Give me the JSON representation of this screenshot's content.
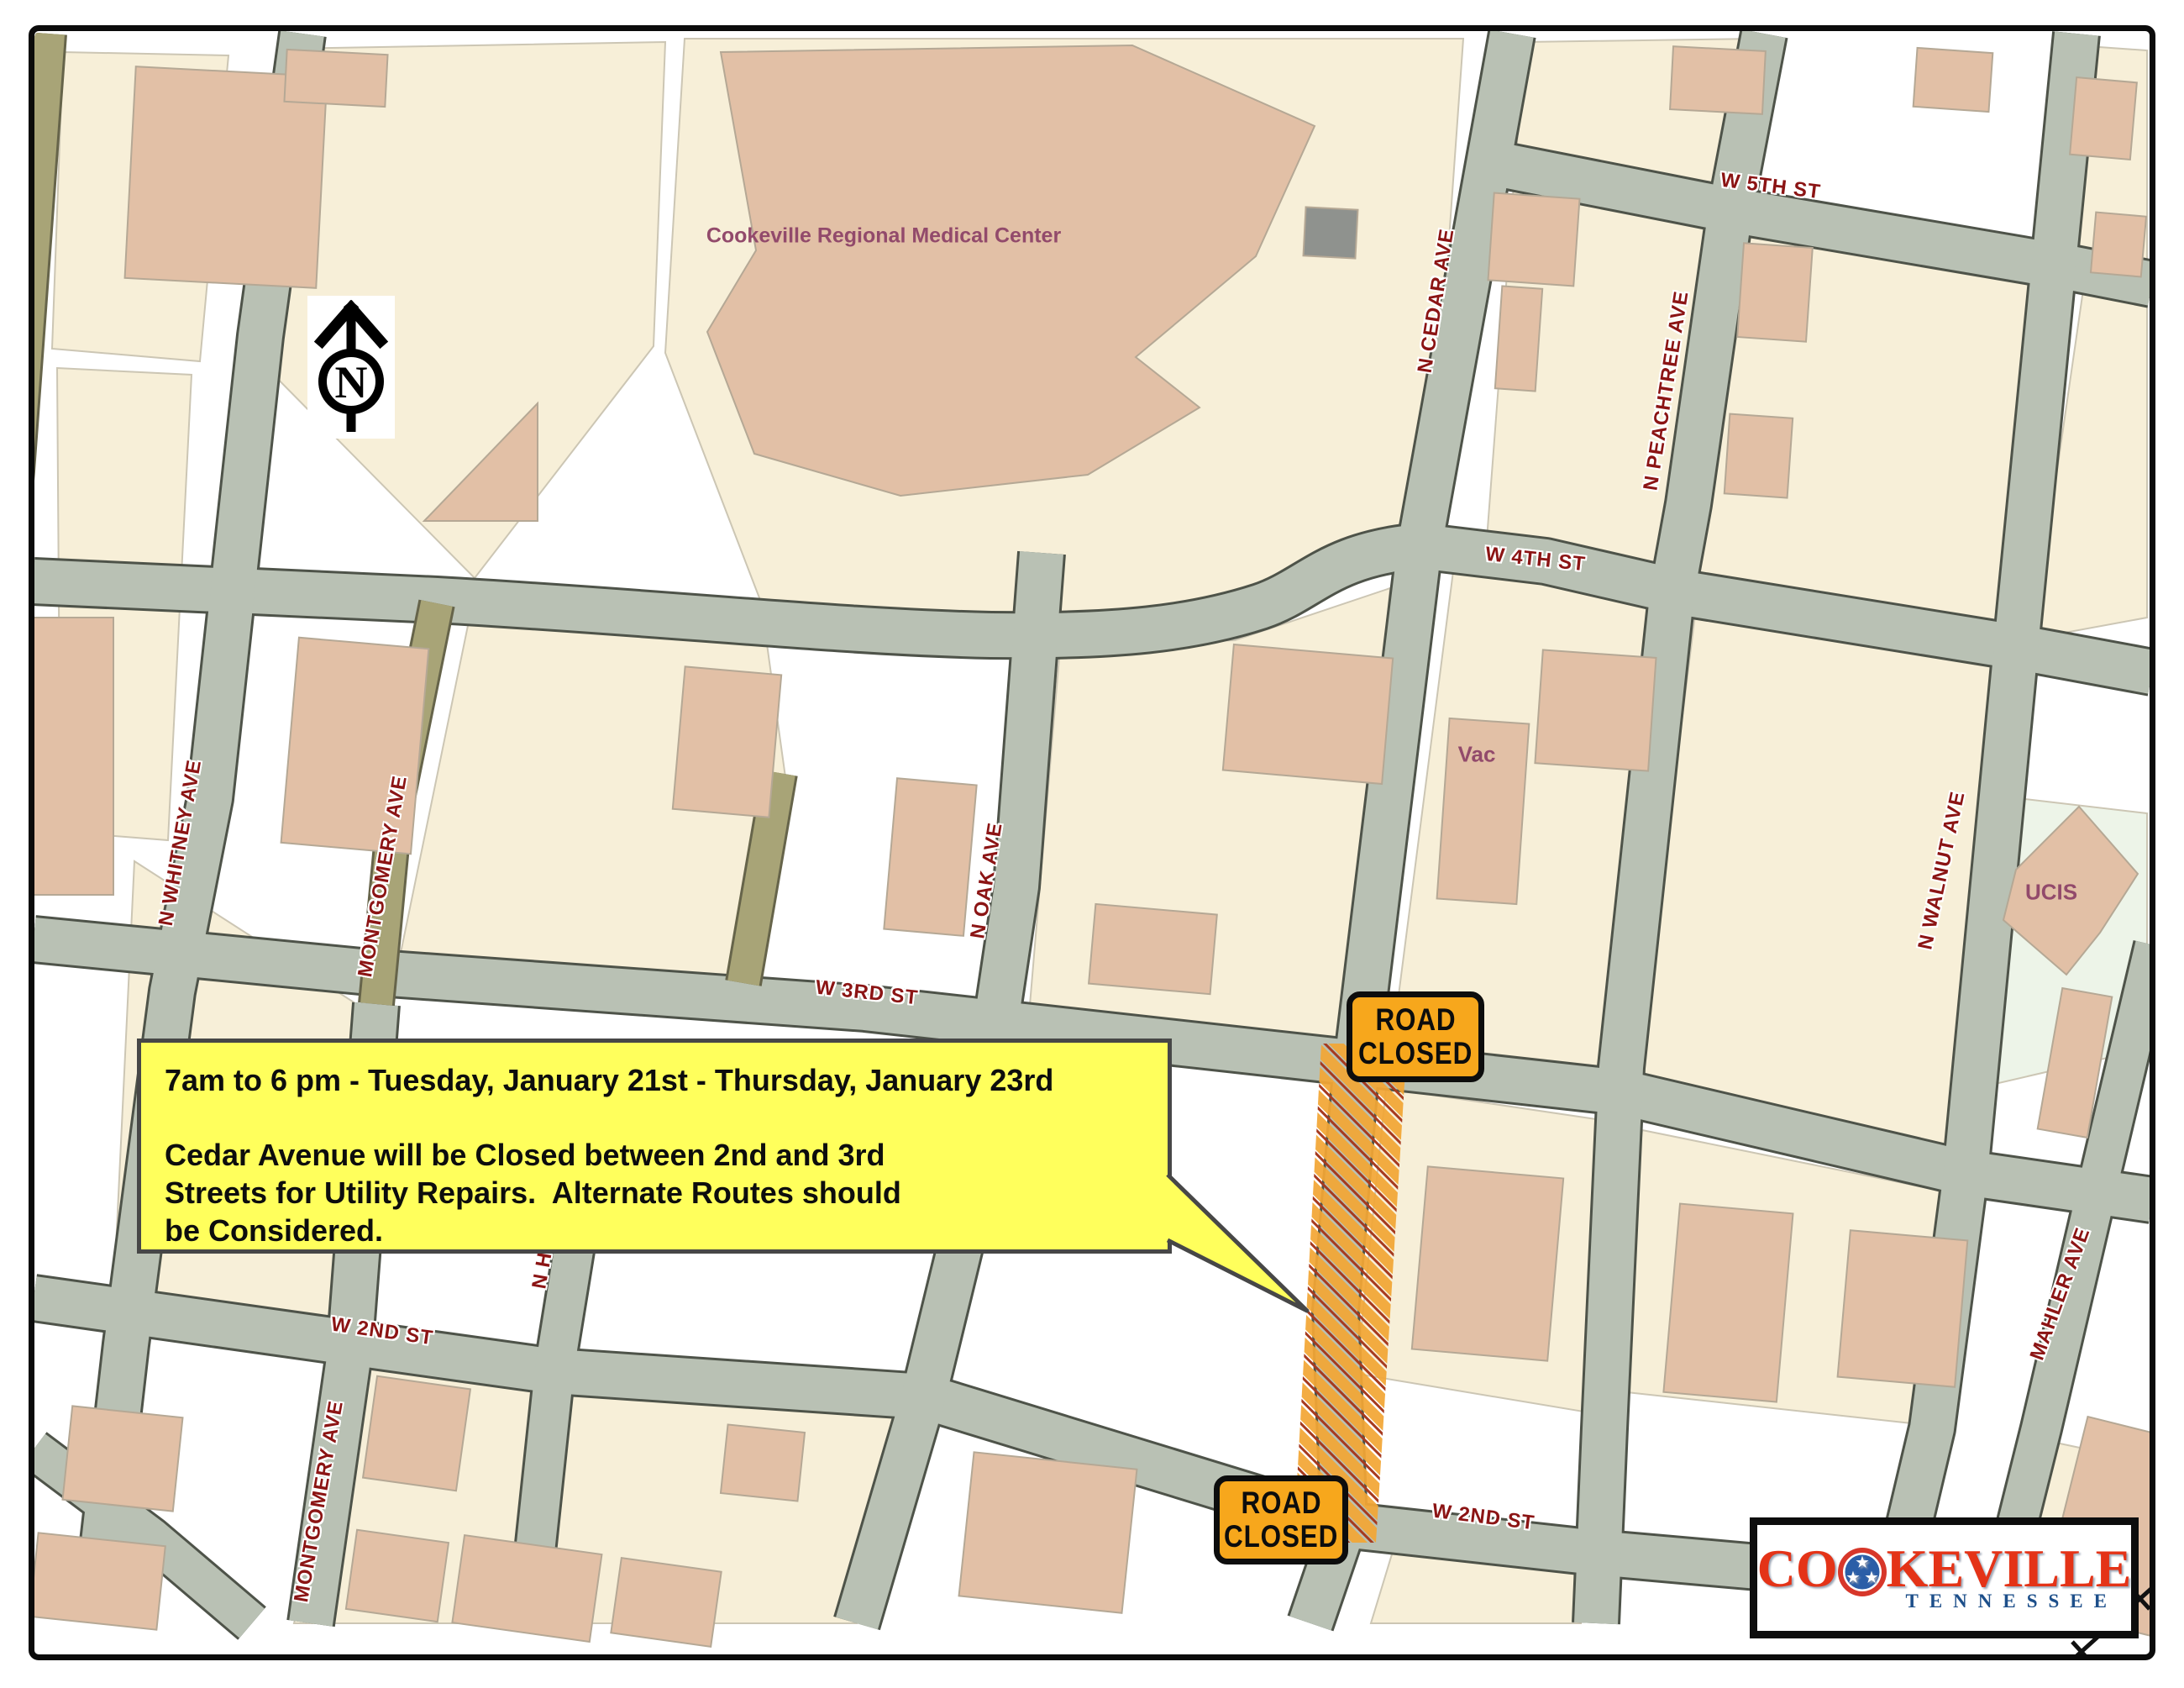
{
  "callout": {
    "schedule_line": "7am to 6 pm - Tuesday, January 21st - Thursday, January 23rd",
    "body": [
      "Cedar Avenue will be Closed between 2nd and 3rd",
      "Streets for Utility Repairs.  Alternate Routes should",
      "be Considered."
    ]
  },
  "road_closed_sign": {
    "line1": "ROAD",
    "line2": "CLOSED"
  },
  "map_labels": {
    "w5th": "W 5TH ST",
    "w4th": "W 4TH ST",
    "w3rd": "W 3RD ST",
    "w2nd_west": "W 2ND ST",
    "w2nd_east": "W 2ND ST",
    "cedar": "N CEDAR AVE",
    "peachtree": "N PEACHTREE AVE",
    "walnut": "N WALNUT AVE",
    "mahler": "MAHLER AVE",
    "whitney": "N WHITNEY AVE",
    "montgomery_north": "MONTGOMERY AVE",
    "montgomery_south": "MONTGOMERY AVE",
    "oak": "N OAK AVE",
    "partial_nh": "N H",
    "medical_center": "Cookeville Regional Medical Center",
    "vac": "Vac",
    "ucis": "UCIS"
  },
  "compass": {
    "north_letter": "N"
  },
  "logo": {
    "name_prefix": "CO",
    "name_suffix": "KEVILLE",
    "state": "TENNESSEE"
  },
  "colors": {
    "road_fill": "#B9C1B4",
    "road_casing": "#4E5349",
    "alley_fill": "#A8A477",
    "parcel_cream": "#F7EFD8",
    "parcel_mint": "#EDF4E8",
    "building_tan": "#E2C0A6",
    "street_label_red": "#8B1414",
    "place_label_purple": "#924A6B",
    "sign_orange": "#F7A71C",
    "callout_yellow": "#FFFF5C",
    "hatch_gold": "#F2A635",
    "hatch_red": "#A63A1F",
    "logo_red": "#E43317",
    "logo_blue": "#1D4F8A"
  }
}
